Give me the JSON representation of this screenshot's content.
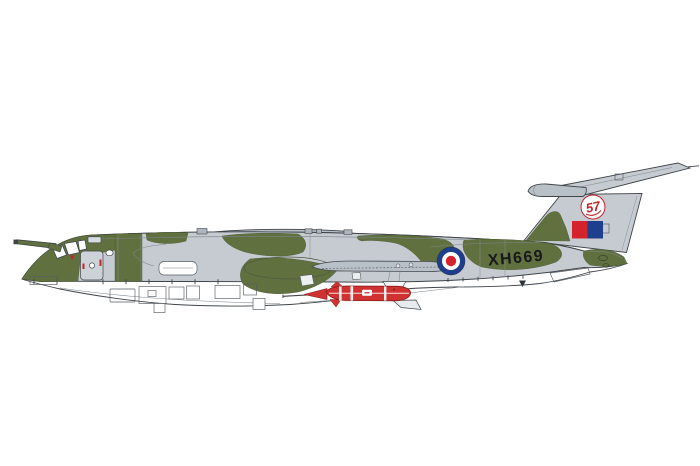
{
  "scene": {
    "background_color": "#ffffff",
    "subject": "Side-profile colour illustration of a camouflaged four-jet V-bomber aircraft with crescent wing, T-tail, nose refuelling probe and a red stand-off missile carried under the fuselage"
  },
  "aircraft": {
    "serial": "XH669",
    "fin_emblem_number": "57",
    "colors": {
      "camo_green": "#60713f",
      "camo_grey": "#c5cbd1",
      "camo_grey_dark": "#b9c1c8",
      "underside_white": "#ffffff",
      "outline": "#3f4449",
      "roundel_blue": "#1d3f8e",
      "roundel_red": "#d5232b",
      "fin_flash_red": "#d5232b",
      "fin_flash_blue": "#1d3f8e",
      "missile_red": "#cf3231",
      "missile_dark_red": "#8c1b1a",
      "serial_black": "#17191b",
      "emblem_red": "#c2252b"
    },
    "markings": {
      "fuselage_roundel": "blue-white-red roundel",
      "fin_flash": "red and blue squares",
      "fin_badge": "white disc with red 57 motif",
      "serial_text": "XH669"
    }
  }
}
